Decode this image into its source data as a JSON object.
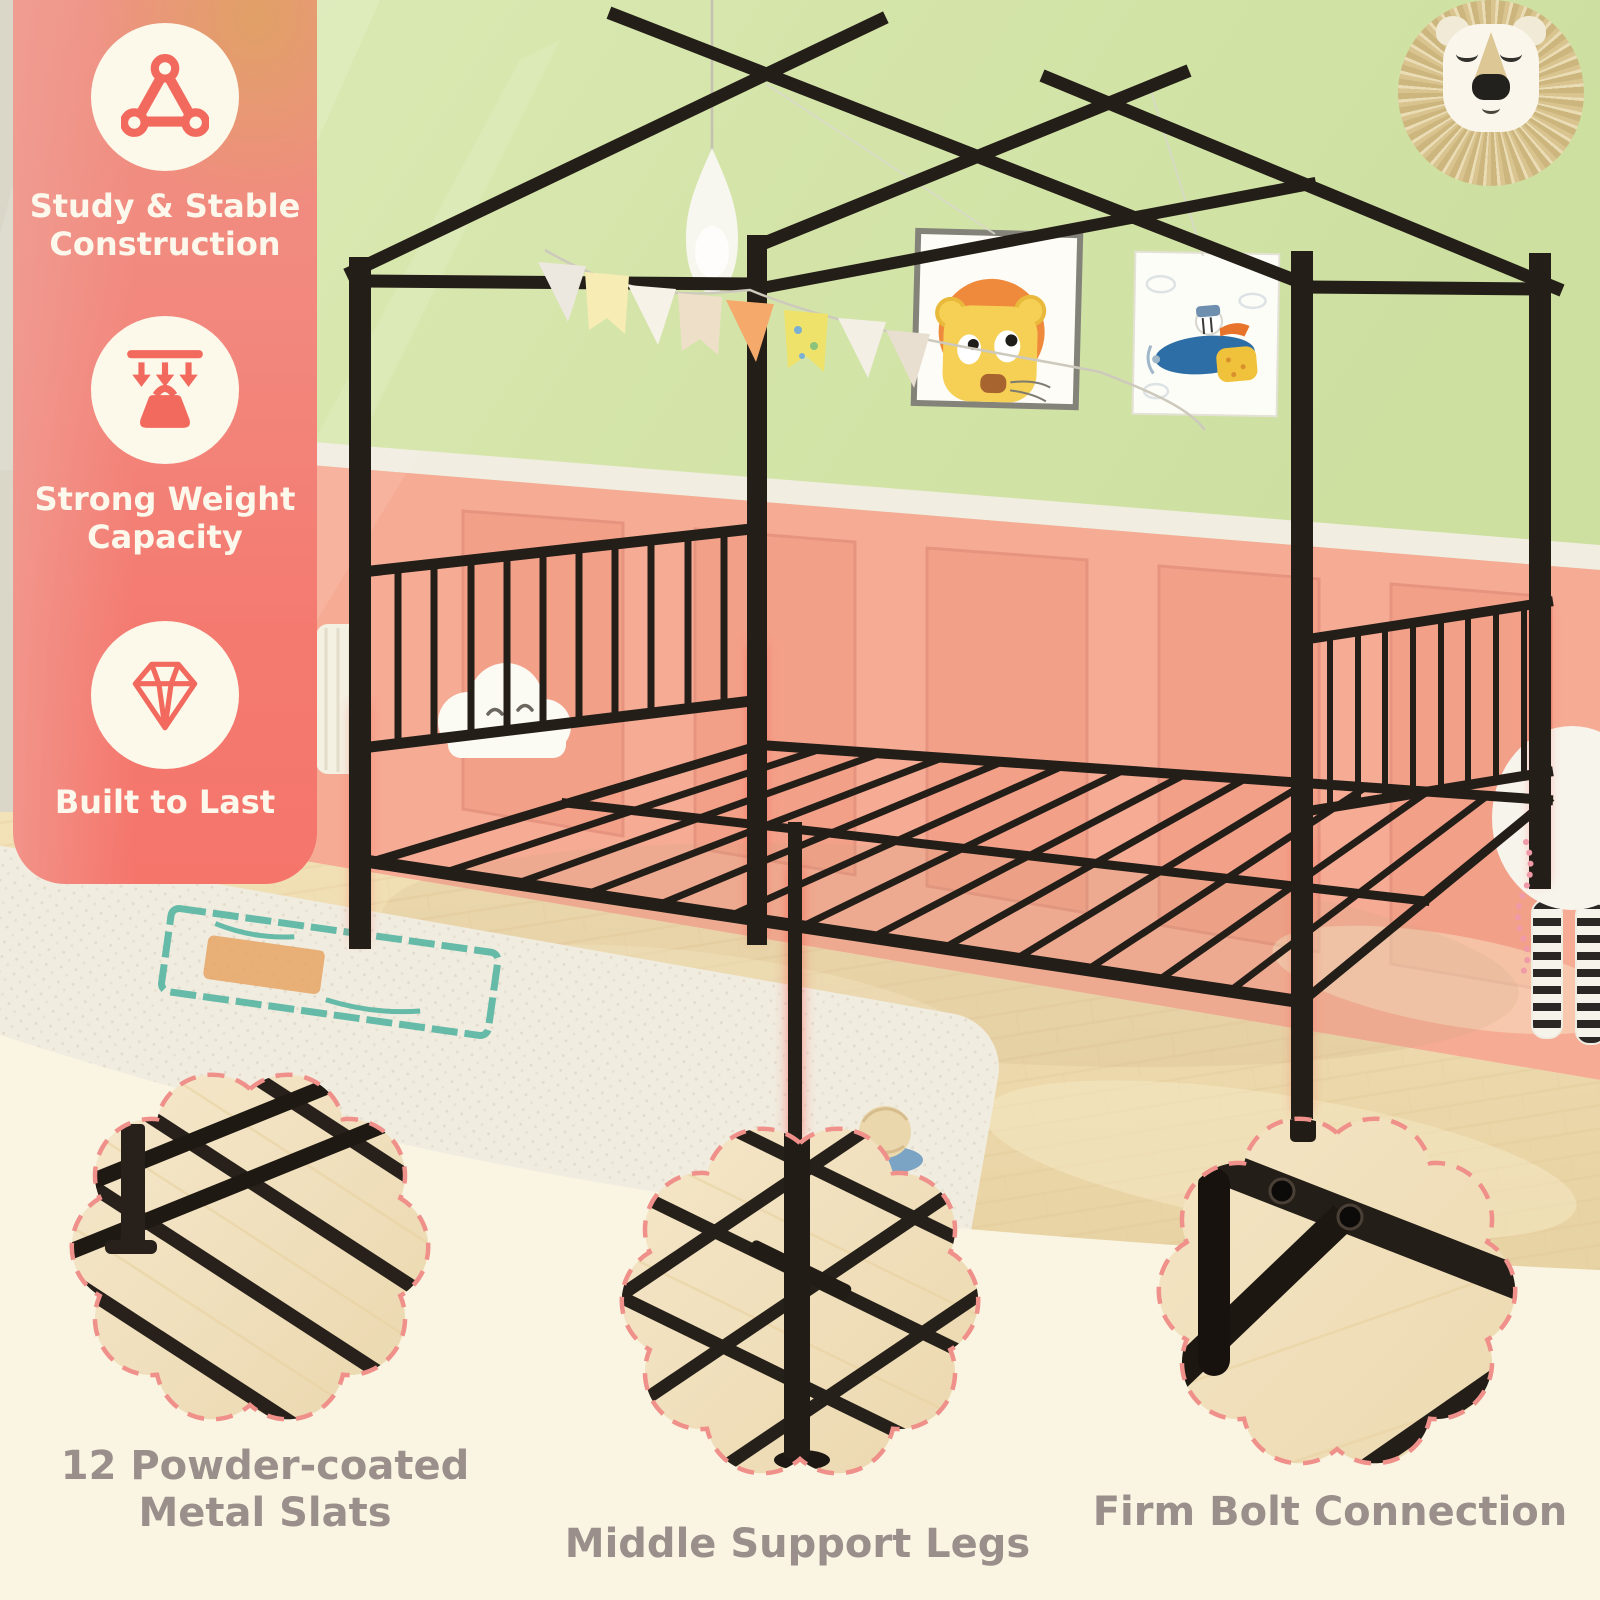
{
  "colors": {
    "accent_coral": "#f4786e",
    "panel_text": "#fcf8ec",
    "icon_coral": "#f2695e",
    "caption_gray": "#9b8f8c",
    "dashed_border": "#f0908a",
    "background_cream": "#f9f5e2",
    "metal_black": "#241e18",
    "glow_red": "#ff5048",
    "wall_green": "#d5e5aa",
    "wainscot_pink": "#f6ab94",
    "floor_wood": "#eedcb2"
  },
  "features_panel": {
    "items": [
      {
        "icon": "triangle-frame-icon",
        "label": "Study & Stable Construction"
      },
      {
        "icon": "weight-capacity-icon",
        "label": "Strong Weight Capacity"
      },
      {
        "icon": "diamond-icon",
        "label": "Built to Last"
      }
    ]
  },
  "callouts": [
    {
      "id": "metal-slats",
      "caption": "12 Powder-coated Metal Slats"
    },
    {
      "id": "middle-support-legs",
      "caption": "Middle Support Legs"
    },
    {
      "id": "firm-bolt-connection",
      "caption": "Firm Bolt Connection"
    }
  ]
}
